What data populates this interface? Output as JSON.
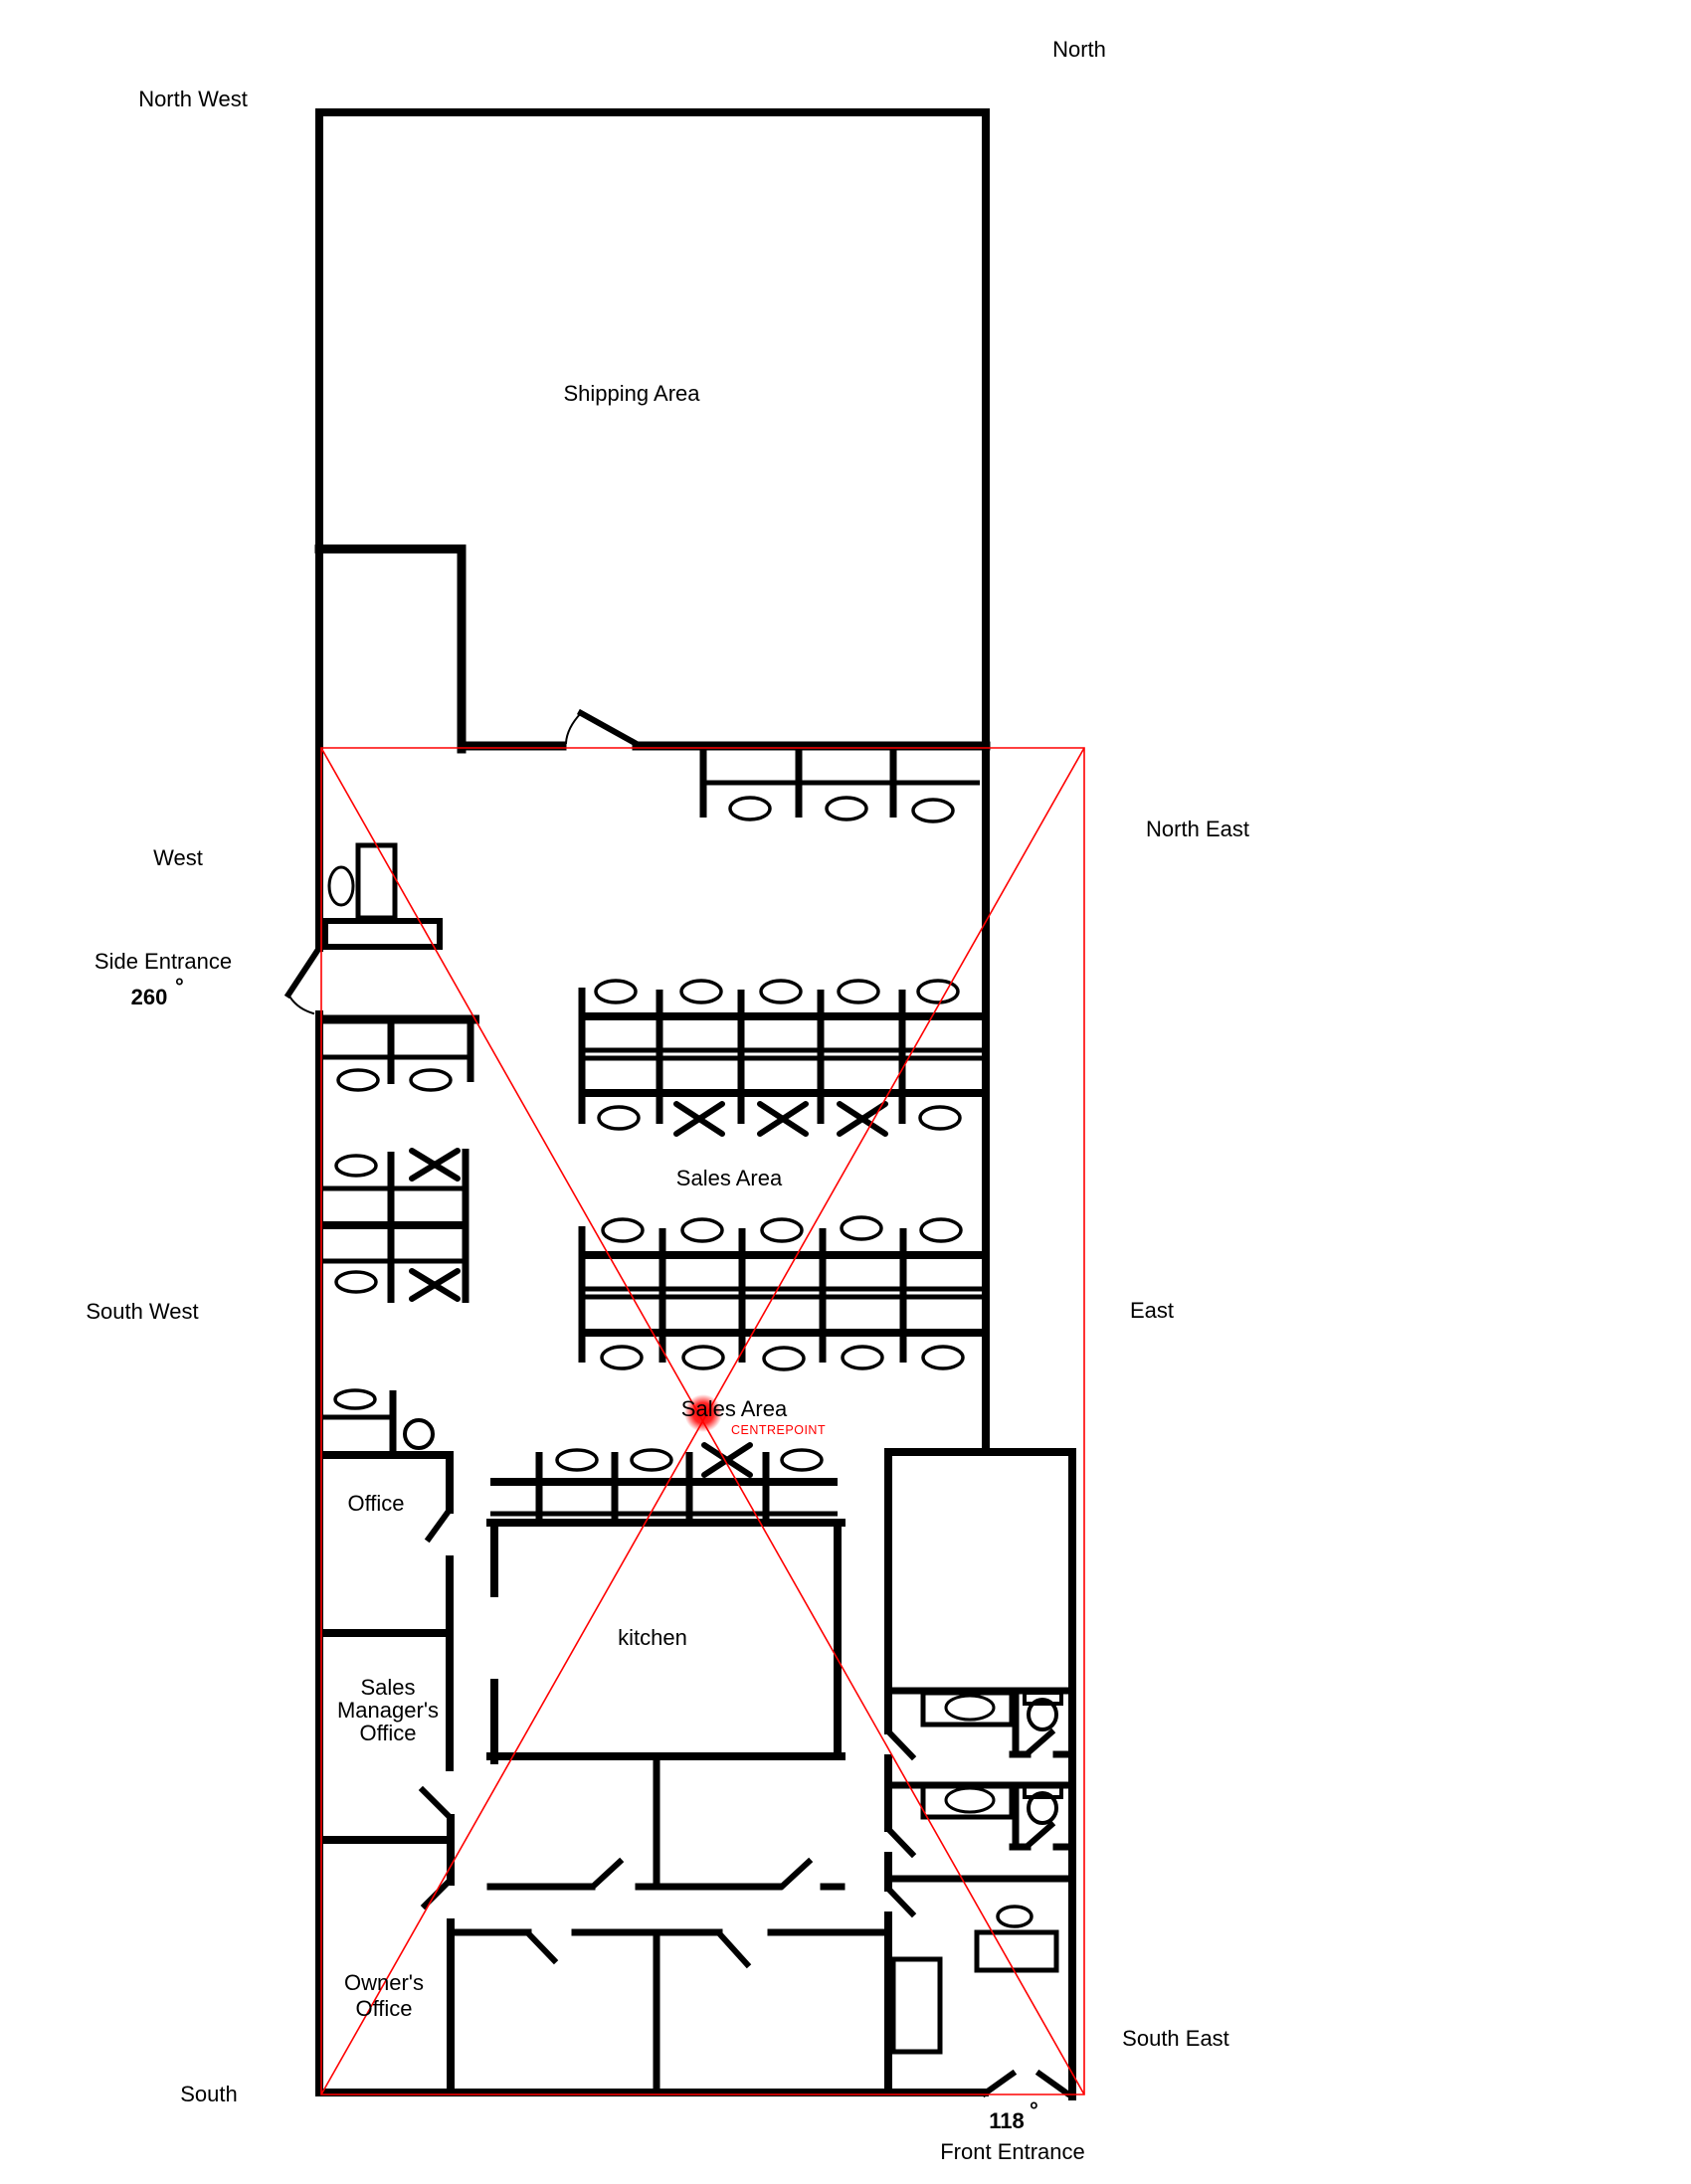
{
  "palette": {
    "background": "#ffffff",
    "wall": "#000000",
    "compass_overlay": "#ff0000",
    "label_text": "#000000",
    "centrepoint_marker": "#ff0000"
  },
  "compass": {
    "north": "North",
    "north_west": "North West",
    "north_east": "North East",
    "west": "West",
    "east": "East",
    "south_west": "South West",
    "south_east": "South East",
    "south": "South"
  },
  "areas": {
    "shipping": "Shipping Area",
    "sales_upper": "Sales Area",
    "sales_lower": "Sales Area",
    "office": "Office",
    "kitchen": "kitchen",
    "sales_manager": [
      "Sales",
      "Manager's",
      "Office"
    ],
    "owner": [
      "Owner's",
      "Office"
    ]
  },
  "entrances": {
    "side": {
      "label": "Side Entrance",
      "angle": "260",
      "degree": "°"
    },
    "front": {
      "label": "Front Entrance",
      "angle": "118",
      "degree": "°"
    }
  },
  "centrepoint": {
    "label": "CENTREPOINT"
  }
}
